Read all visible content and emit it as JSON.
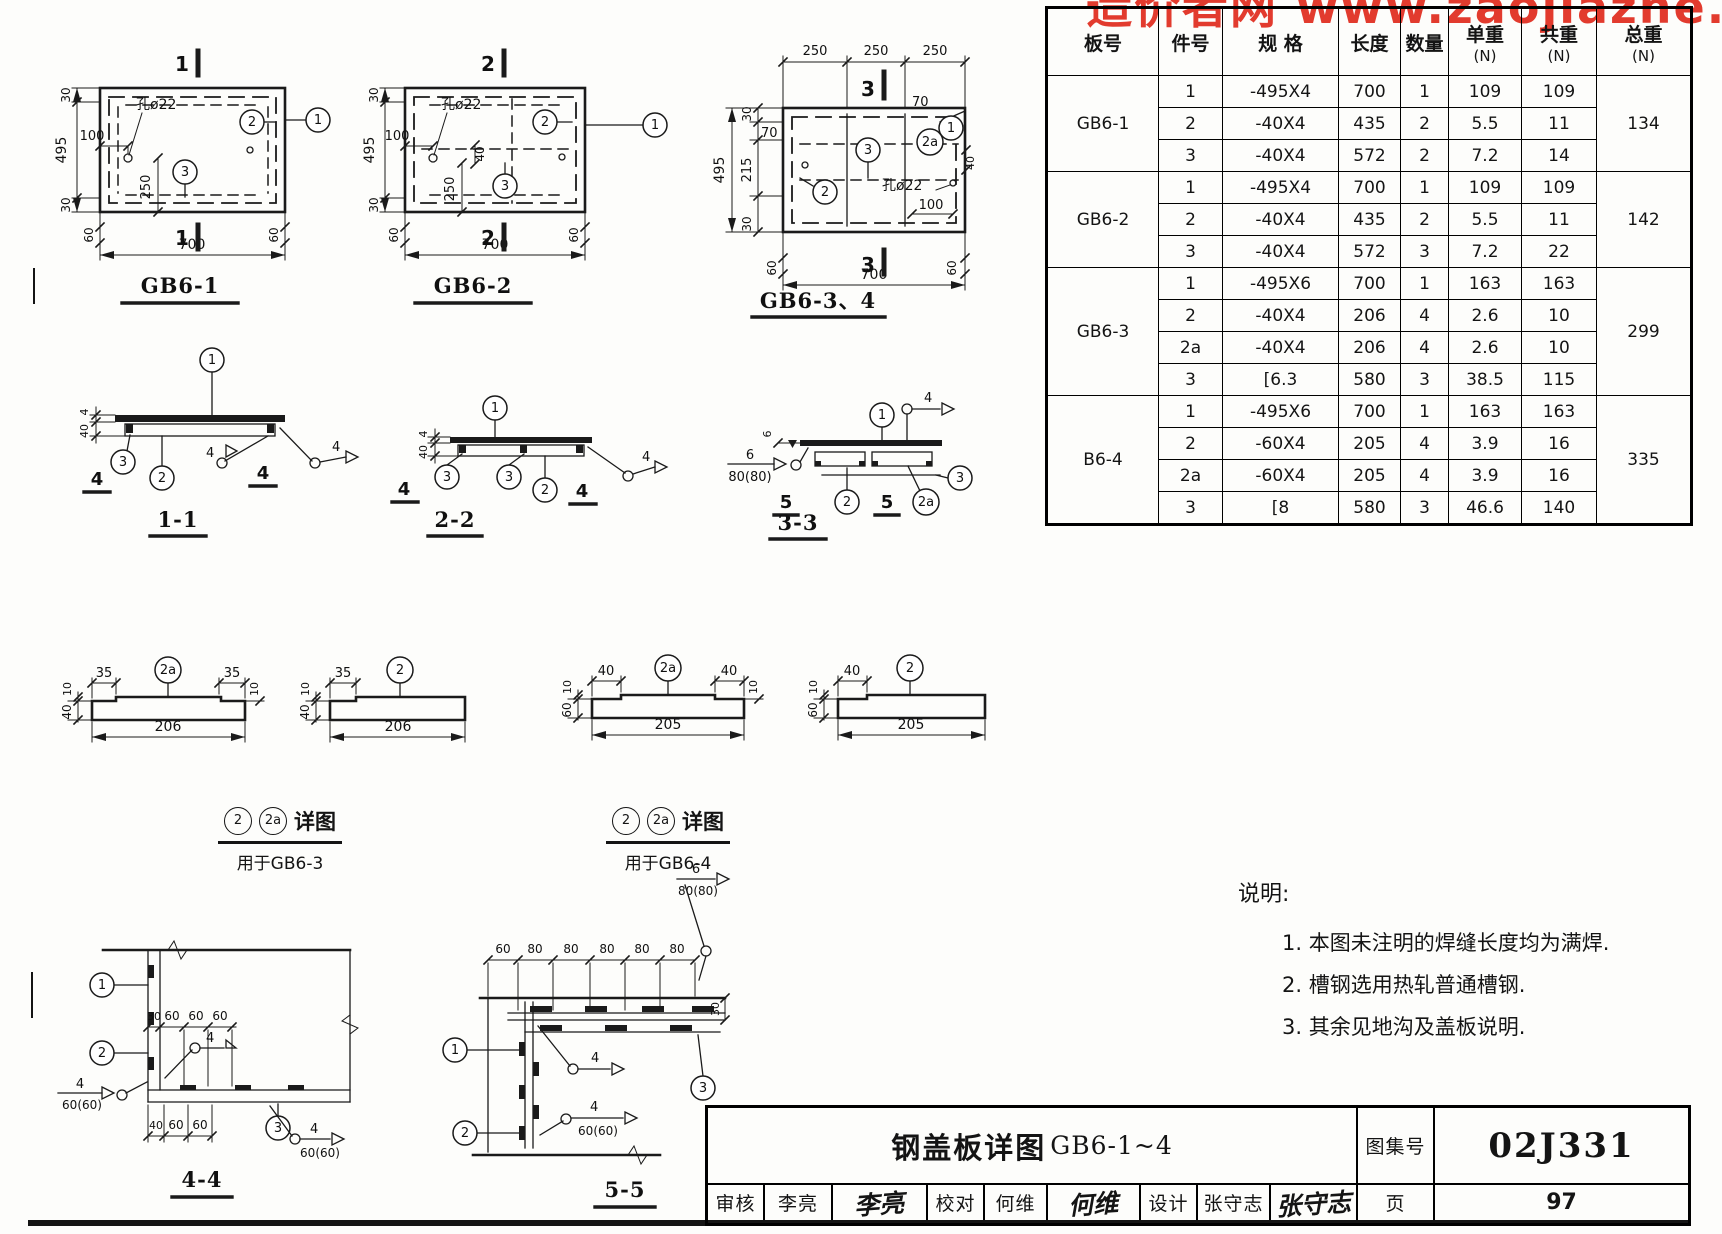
{
  "watermark": {
    "text": "造价者网 www.zaojiazhe.co"
  },
  "plans": {
    "p1": {
      "title": "GB6-1",
      "sec": "1",
      "d495": "495",
      "d30": "30",
      "d100": "100",
      "d250": "250",
      "d700": "700",
      "d60": "60",
      "hole": "孔ø22",
      "c1": "1",
      "c2": "2",
      "c3": "3"
    },
    "p2": {
      "title": "GB6-2",
      "sec": "2",
      "d495": "495",
      "d30": "30",
      "d100": "100",
      "d40": "40",
      "d250": "250",
      "d700": "700",
      "d60": "60",
      "hole": "孔ø22",
      "c1": "1",
      "c2": "2",
      "c3": "3"
    },
    "p3": {
      "title": "GB6-3、4",
      "sec": "3",
      "d250": "250",
      "d30": "30",
      "d70": "70",
      "d215": "215",
      "d495": "495",
      "d40": "40",
      "d100": "100",
      "d700": "700",
      "d60": "60",
      "hole": "孔ø22",
      "c1": "1",
      "c2": "2",
      "c2a": "2a",
      "c3": "3"
    }
  },
  "sections": {
    "s1": {
      "title": "1-1",
      "c1": "1",
      "c2": "2",
      "c3": "3",
      "d40": "40",
      "d4": "4",
      "w4": "4",
      "cut": "4"
    },
    "s2": {
      "title": "2-2",
      "c1": "1",
      "c2": "2",
      "c3": "3",
      "d40": "40",
      "d4": "4",
      "w4": "4",
      "cut": "4"
    },
    "s3": {
      "title": "3-3",
      "c1": "1",
      "c2": "2",
      "c2a": "2a",
      "c3": "3",
      "d6": "6",
      "w4": "4",
      "w6": "6",
      "w80": "80(80)",
      "cut": "5"
    }
  },
  "details": {
    "d1": {
      "co": "2a",
      "d35": "35",
      "d10": "10",
      "d40": "40",
      "len": "206"
    },
    "d2": {
      "co": "2",
      "d35": "35",
      "d10": "10",
      "d40": "40",
      "len": "206"
    },
    "d3": {
      "co": "2a",
      "d40": "40",
      "d10": "10",
      "d60": "60",
      "len": "205"
    },
    "d4": {
      "co": "2",
      "d40": "40",
      "d10": "10",
      "d60": "60",
      "len": "205"
    },
    "cap1": {
      "c2": "2",
      "c2a": "2a",
      "t": "详图",
      "sub": "用于GB6-3"
    },
    "cap2": {
      "c2": "2",
      "c2a": "2a",
      "t": "详图",
      "sub": "用于GB6-4"
    }
  },
  "c44": {
    "title": "4-4",
    "c1": "1",
    "c2": "2",
    "c3": "3",
    "t0": "30",
    "t1": "60",
    "t2": "60",
    "t3": "60",
    "b0": "40",
    "b1": "60",
    "b2": "60",
    "w4": "4",
    "w60": "60(60)"
  },
  "c55": {
    "title": "5-5",
    "c1": "1",
    "c2": "2",
    "c3": "3",
    "t0": "60",
    "t1": "80",
    "t2": "80",
    "t3": "80",
    "t4": "80",
    "t5": "80",
    "d30": "30",
    "w4": "4",
    "w60": "60(60)",
    "w6": "6",
    "w80": "80(80)"
  },
  "notes": {
    "heading": "说明:",
    "items": [
      "1. 本图未注明的焊缝长度均为满焊.",
      "2. 槽钢选用热轧普通槽钢.",
      "3. 其余见地沟及盖板说明."
    ]
  },
  "table": {
    "headers": [
      "板号",
      "件号",
      "规  格",
      "长度",
      "数量",
      "单重",
      "共重",
      "总重"
    ],
    "unit": "(N)",
    "groups": [
      {
        "name": "GB6-1",
        "total": "134",
        "rows": [
          [
            "1",
            "-495X4",
            "700",
            "1",
            "109",
            "109"
          ],
          [
            "2",
            "-40X4",
            "435",
            "2",
            "5.5",
            "11"
          ],
          [
            "3",
            "-40X4",
            "572",
            "2",
            "7.2",
            "14"
          ]
        ]
      },
      {
        "name": "GB6-2",
        "total": "142",
        "rows": [
          [
            "1",
            "-495X4",
            "700",
            "1",
            "109",
            "109"
          ],
          [
            "2",
            "-40X4",
            "435",
            "2",
            "5.5",
            "11"
          ],
          [
            "3",
            "-40X4",
            "572",
            "3",
            "7.2",
            "22"
          ]
        ]
      },
      {
        "name": "GB6-3",
        "total": "299",
        "rows": [
          [
            "1",
            "-495X6",
            "700",
            "1",
            "163",
            "163"
          ],
          [
            "2",
            "-40X4",
            "206",
            "4",
            "2.6",
            "10"
          ],
          [
            "2a",
            "-40X4",
            "206",
            "4",
            "2.6",
            "10"
          ],
          [
            "3",
            "[6.3",
            "580",
            "3",
            "38.5",
            "115"
          ]
        ]
      },
      {
        "name": "B6-4",
        "total": "335",
        "rows": [
          [
            "1",
            "-495X6",
            "700",
            "1",
            "163",
            "163"
          ],
          [
            "2",
            "-60X4",
            "205",
            "4",
            "3.9",
            "16"
          ],
          [
            "2a",
            "-60X4",
            "205",
            "4",
            "3.9",
            "16"
          ],
          [
            "3",
            "[8",
            "580",
            "3",
            "46.6",
            "140"
          ]
        ]
      }
    ]
  },
  "titleblock": {
    "drawing_title": "钢盖板详图",
    "drawing_no": "GB6-1~4",
    "atlas_label": "图集号",
    "atlas_no": "02J331",
    "page_label": "页",
    "page_no": "97",
    "reviewer_label": "审核",
    "reviewer": "李亮",
    "checker_label": "校对",
    "checker": "何维",
    "designer_label": "设计",
    "designer": "张守志",
    "sig1": "李亮",
    "sig2": "何维",
    "sig3": "张守志"
  }
}
